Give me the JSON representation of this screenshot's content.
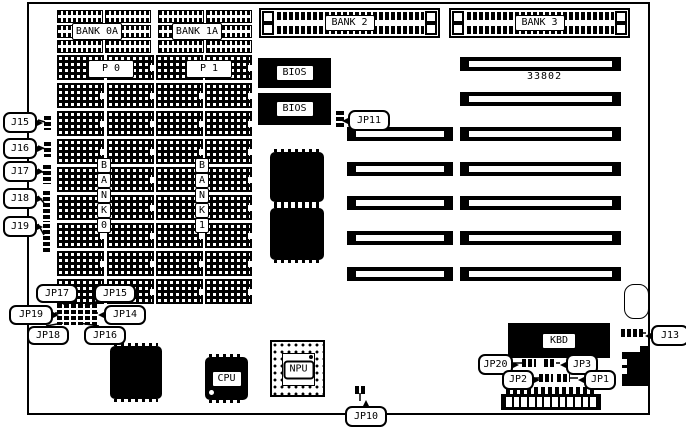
{
  "diagram": {
    "part_number": "33802",
    "memory": {
      "bank0a": "BANK 0A",
      "bank1a": "BANK 1A",
      "bank2": "BANK 2",
      "bank3": "BANK 3",
      "p0": "P 0",
      "p1": "P 1",
      "bank0_vertical": "BANK0",
      "bank1_vertical": "BANK1"
    },
    "chips": {
      "bios_top": "BIOS",
      "bios_bottom": "BIOS",
      "cpu": "CPU",
      "npu": "NPU",
      "kbd": "KBD"
    },
    "callouts": [
      {
        "id": "j15",
        "label": "J15"
      },
      {
        "id": "j16",
        "label": "J16"
      },
      {
        "id": "j17",
        "label": "J17"
      },
      {
        "id": "j18",
        "label": "J18"
      },
      {
        "id": "j19",
        "label": "J19"
      },
      {
        "id": "jp17",
        "label": "JP17"
      },
      {
        "id": "jp15",
        "label": "JP15"
      },
      {
        "id": "jp19",
        "label": "JP19"
      },
      {
        "id": "jp14",
        "label": "JP14"
      },
      {
        "id": "jp18",
        "label": "JP18"
      },
      {
        "id": "jp16",
        "label": "JP16"
      },
      {
        "id": "jp11",
        "label": "JP11"
      },
      {
        "id": "j13",
        "label": "J13"
      },
      {
        "id": "jp20",
        "label": "JP20"
      },
      {
        "id": "jp3",
        "label": "JP3"
      },
      {
        "id": "jp2",
        "label": "JP2"
      },
      {
        "id": "jp1",
        "label": "JP1"
      },
      {
        "id": "jp10",
        "label": "JP10"
      }
    ]
  }
}
